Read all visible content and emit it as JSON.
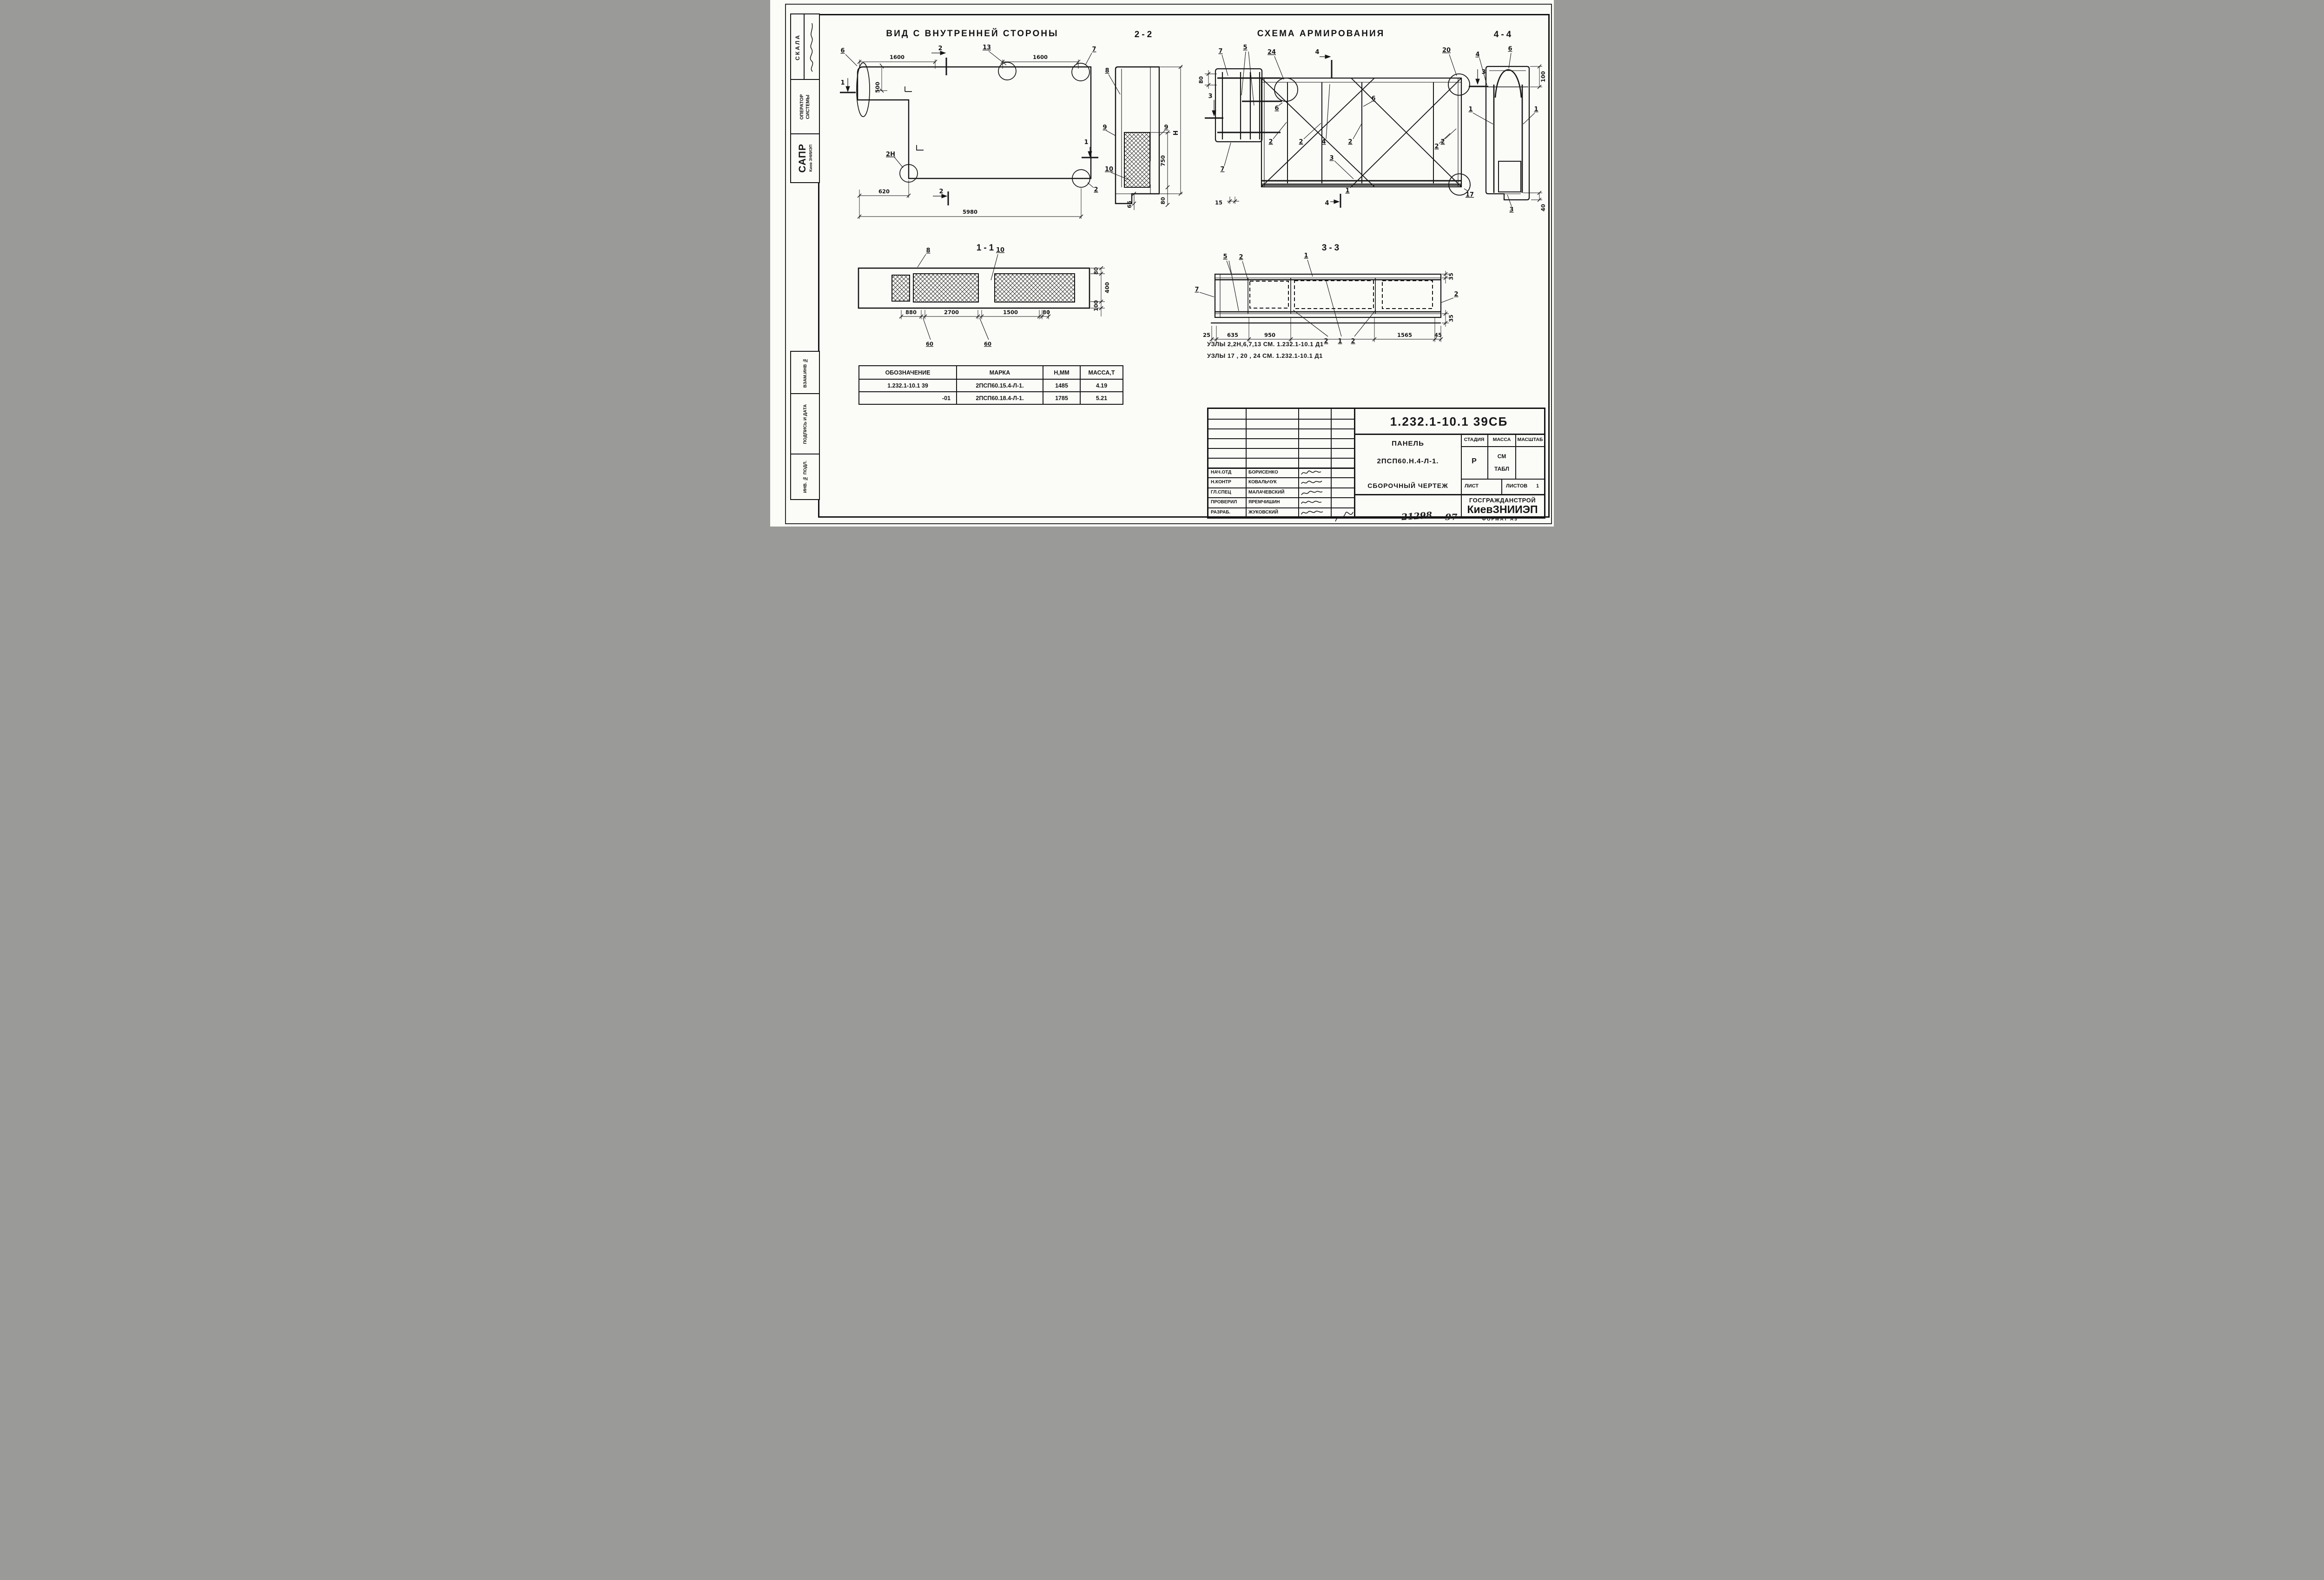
{
  "page": {
    "format_label": "ФОРМАТ А3",
    "handwritten_code": "21298",
    "handwritten_sheet": "97"
  },
  "sidebar": {
    "skala": "СКАЛА",
    "operator_line1": "ОПЕРАТОР",
    "operator_line2": "СИСТЕМЫ",
    "sapr": "САПР",
    "sapr_sub": "Киев ЗНИИЭП",
    "vzam": "ВЗАМ.ИНВ №",
    "podpis": "ПОДПИСЬ И ДАТА",
    "inv": "ИНВ. № ПОДЛ."
  },
  "views": {
    "view1": {
      "title": "ВИД С ВНУТРЕННЕЙ СТОРОНЫ",
      "dim_1600_left": "1600",
      "dim_1600_right": "1600",
      "dim_500": "500",
      "dim_620": "620",
      "dim_5980": "5980",
      "label_6": "6",
      "label_13": "13",
      "label_7": "7",
      "label_2n": "2Н",
      "label_2_node": "2",
      "marker_2_top": "2",
      "marker_2_bottom": "2",
      "marker_1_left": "1",
      "marker_1_mid": "1"
    },
    "view2": {
      "title": "2-2",
      "label_8": "8",
      "label_9_left": "9",
      "label_9_right": "9",
      "label_10": "10",
      "dim_h": "Н",
      "dim_750": "750",
      "dim_80": "80",
      "dim_65": "65"
    },
    "view3": {
      "title": "СХЕМА АРМИРОВАНИЯ",
      "label_7_top": "7",
      "label_5": "5",
      "label_24": "24",
      "marker_4_top": "4",
      "dim_80": "80",
      "marker_3_left": "3",
      "label_7_low": "7",
      "dim_15": "15",
      "label_6_left": "6",
      "label_6_right": "6",
      "label_2_a": "2",
      "label_2_b": "2",
      "label_4_bar": "4",
      "label_2_c": "2",
      "label_2_d": "2",
      "label_3_bars": "3",
      "label_1_bottom": "1",
      "marker_4_bottom": "4",
      "label_20": "20",
      "label_17": "17",
      "marker_3_right": "3",
      "label_2_right": "2"
    },
    "view4": {
      "title": "4-4",
      "label_4": "4",
      "label_6": "6",
      "label_1_left": "1",
      "label_1_right": "1",
      "label_3": "3",
      "dim_100": "100",
      "dim_40": "40"
    },
    "view5": {
      "title": "1-1",
      "label_8": "8",
      "label_10": "10",
      "dim_880": "880",
      "dim_2700": "2700",
      "dim_1500": "1500",
      "dim_80": "80",
      "dim_60_a": "60",
      "dim_60_b": "60",
      "dim_80_right": "80",
      "dim_400": "400",
      "dim_100": "100"
    },
    "view6": {
      "title": "3-3",
      "label_5": "5",
      "label_2_top": "2",
      "label_1_top": "1",
      "label_7": "7",
      "label_2_right": "2",
      "dim_25": "25",
      "dim_635": "635",
      "dim_950": "950",
      "label_2_a": "2",
      "label_1_mid": "1",
      "label_2_b": "2",
      "dim_1565": "1565",
      "dim_45": "45",
      "dim_35_top": "35",
      "dim_35_bottom": "35"
    }
  },
  "notes": {
    "line1": "УЗЛЫ 2,2Н,6,7,13  СМ. 1.232.1-10.1 Д1",
    "line2": "УЗЛЫ 17 , 20 , 24   СМ. 1.232.1-10.1 Д1"
  },
  "table": {
    "headers": [
      "ОБОЗНАЧЕНИЕ",
      "МАРКА",
      "Н,ММ",
      "МАССА,Т"
    ],
    "rows": [
      [
        "1.232.1-10.1 39",
        "2ПСП60.15.4-Л-1.",
        "1485",
        "4.19"
      ],
      [
        "-01",
        "2ПСП60.18.4-Л-1.",
        "1785",
        "5.21"
      ]
    ]
  },
  "titleblock": {
    "doc_number": "1.232.1-10.1 39СБ",
    "product_line1": "ПАНЕЛЬ",
    "product_line2": "2ПСП60.Н.4-Л-1.",
    "product_line3": "СБОРОЧНЫЙ ЧЕРТЕЖ",
    "col_stage": "СТАДИЯ",
    "col_mass": "МАССА",
    "col_scale": "МАСШТАБ",
    "stage_value": "Р",
    "mass_value_line1": "СМ",
    "mass_value_line2": "ТАБЛ",
    "sheet_label": "ЛИСТ",
    "sheets_label": "ЛИСТОВ",
    "sheets_value": "1",
    "org_line1": "ГОСГРАЖДАНСТРОЙ",
    "org_line2": "КиевЗНИИЭП",
    "signatures": [
      {
        "role": "НАЧ.ОТД",
        "name": "БОРИСЕНКО"
      },
      {
        "role": "Н.КОНТР",
        "name": "КОВАЛЬЧУК"
      },
      {
        "role": "ГЛ.СПЕЦ",
        "name": "МАЛАЧЕВСКИЙ"
      },
      {
        "role": "ПРОВЕРИЛ",
        "name": "ЯРЕМЧИШИН"
      },
      {
        "role": "РАЗРАБ.",
        "name": "ЖУКОВСКИЙ"
      }
    ]
  }
}
